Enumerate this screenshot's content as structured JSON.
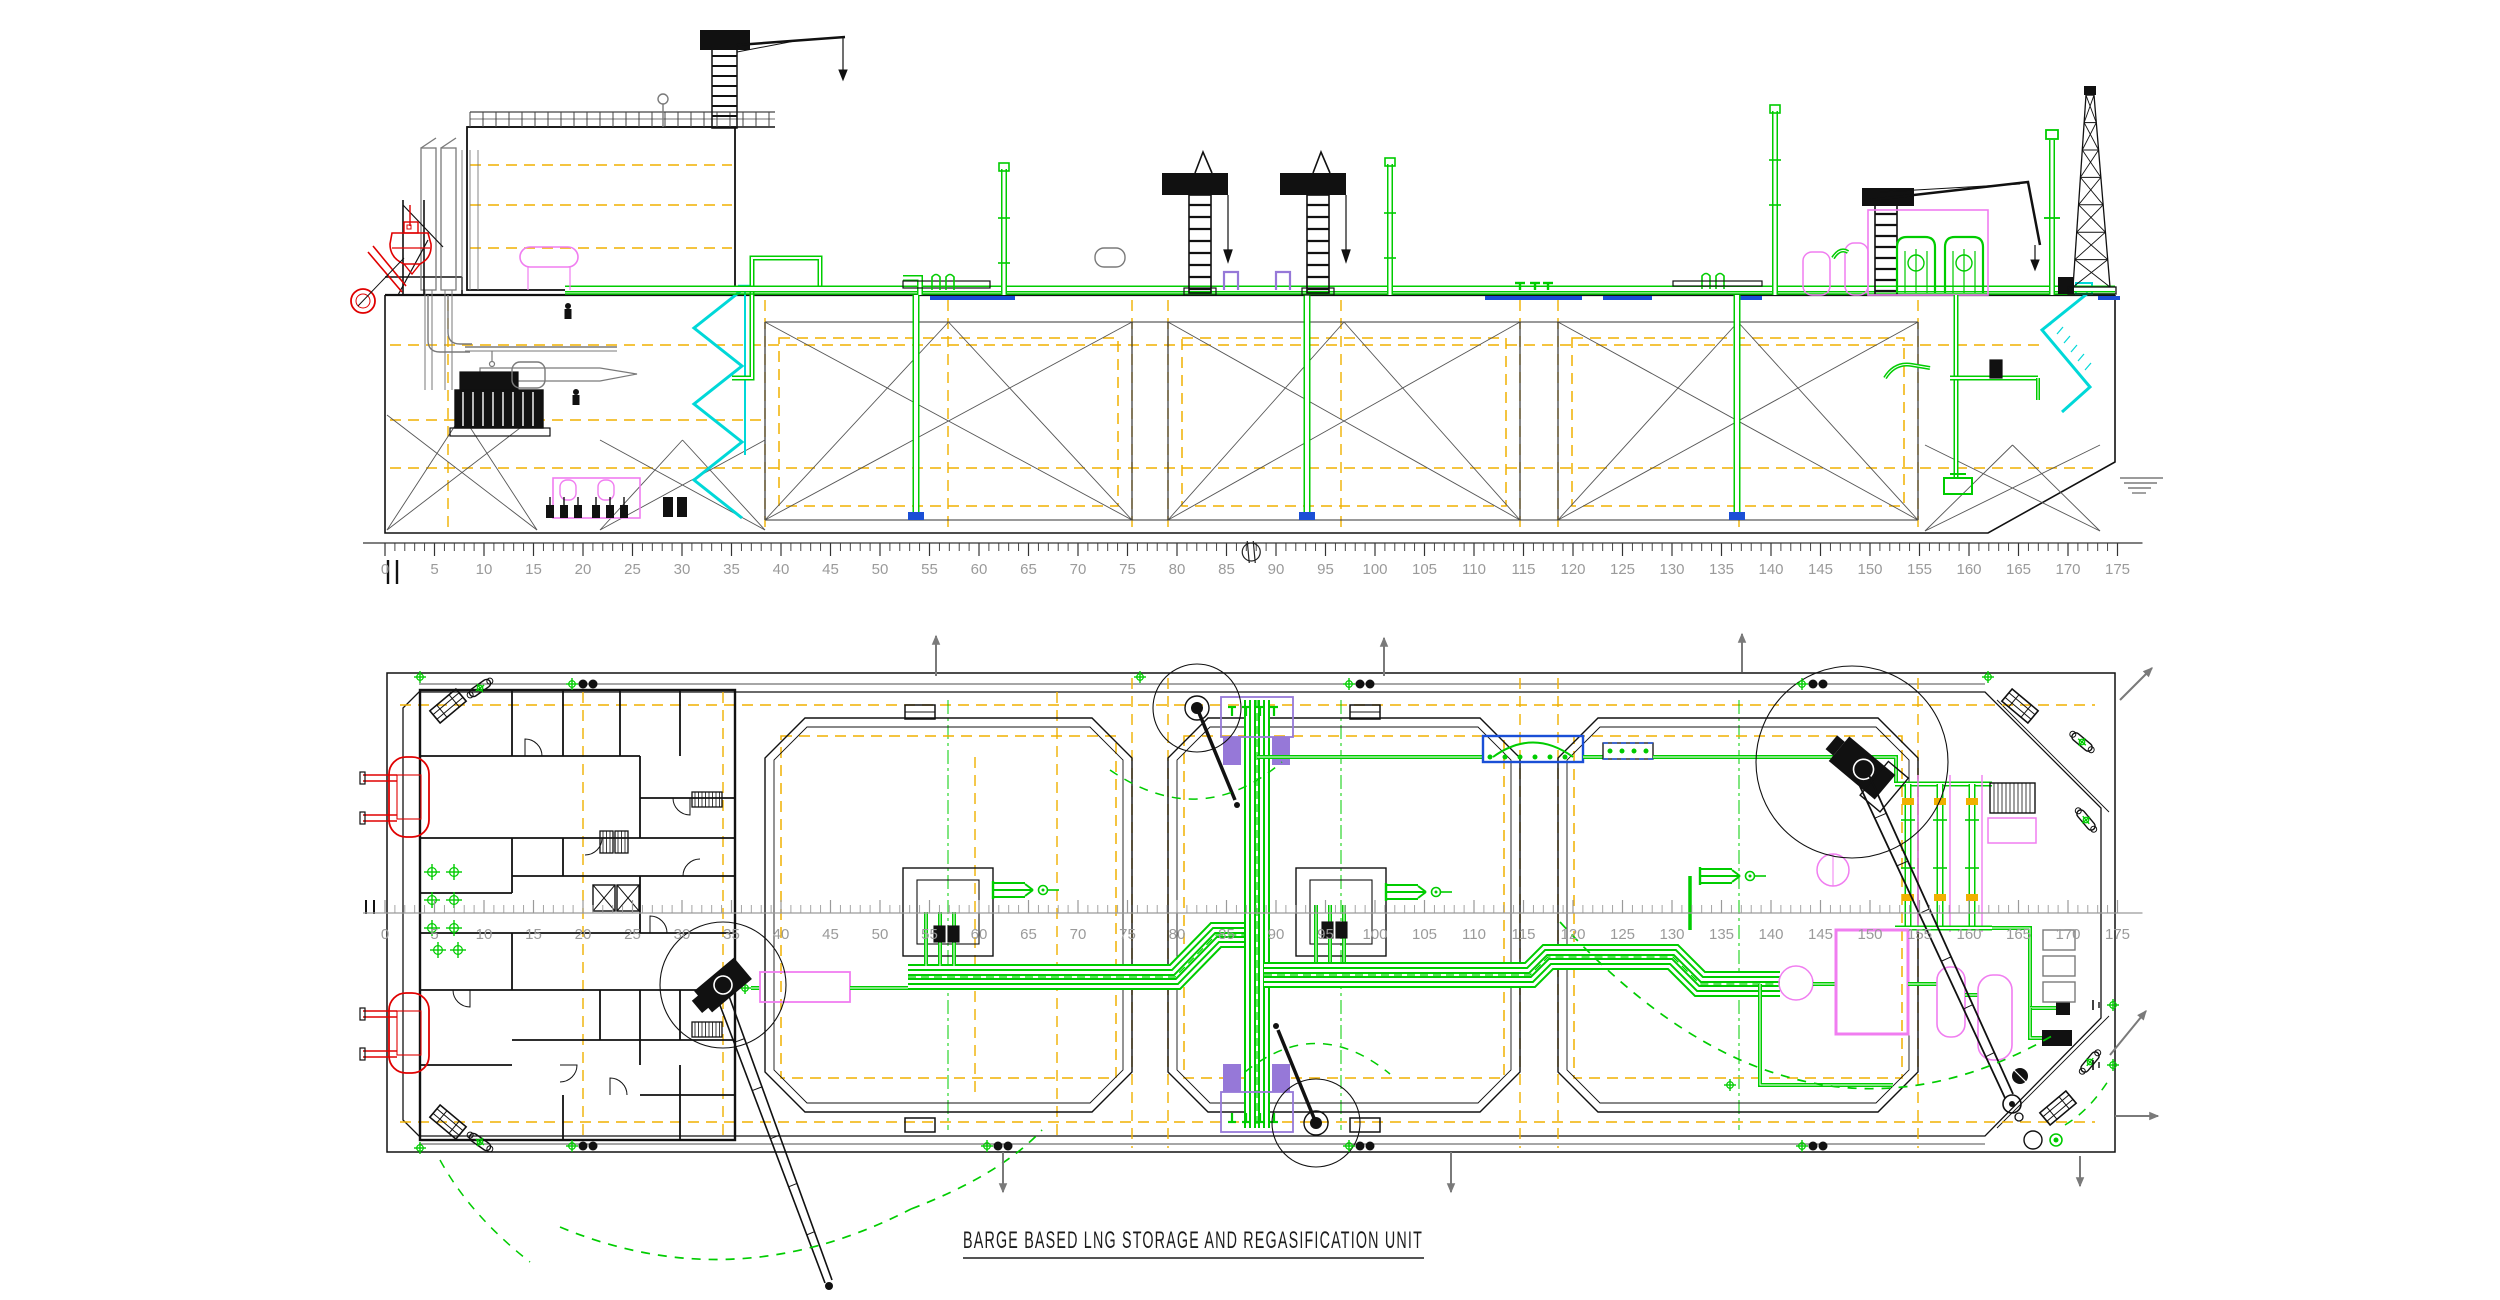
{
  "title": {
    "text": "BARGE BASED LNG STORAGE AND REGASIFICATION UNIT"
  },
  "rulers": {
    "station_labels": [
      "0",
      "5",
      "10",
      "15",
      "20",
      "25",
      "30",
      "35",
      "40",
      "45",
      "50",
      "55",
      "60",
      "65",
      "70",
      "75",
      "80",
      "85",
      "90",
      "95",
      "100",
      "105",
      "110",
      "115",
      "120",
      "125",
      "130",
      "135",
      "140",
      "145",
      "150",
      "155",
      "160",
      "165",
      "170",
      "175"
    ]
  },
  "colors": {
    "piping_green": "#00cc00",
    "centerline_orange": "#f0b000",
    "stairs_cyan": "#00d8d8",
    "equipment_magenta": "#f07df0",
    "manifold_violet": "#9678d8",
    "safety_red": "#e00000",
    "hatch_blue": "#1a4fd6",
    "ruler_gray": "#9a9a9a",
    "structure_gray": "#7a7a7a",
    "line_black": "#000000"
  }
}
